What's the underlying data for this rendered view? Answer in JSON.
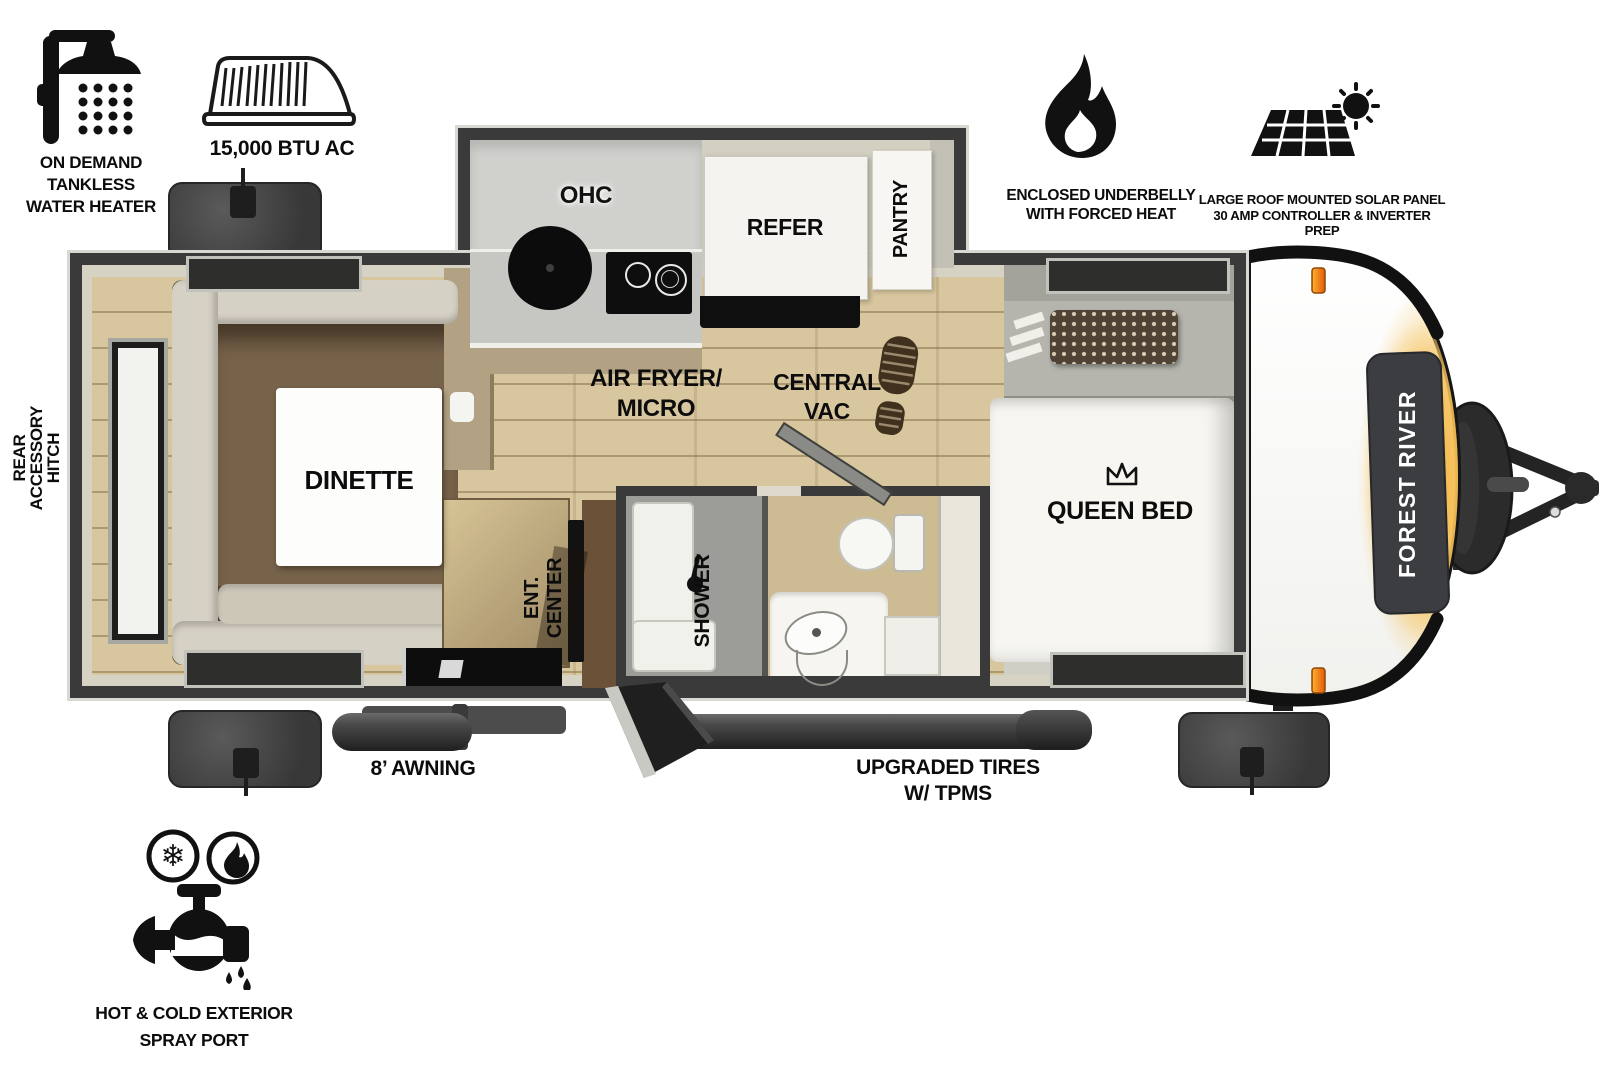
{
  "callouts": {
    "water_heater": "ON DEMAND\nTANKLESS\nWATER HEATER",
    "ac": "15,000 BTU AC",
    "underbelly": "ENCLOSED UNDERBELLY\nWITH FORCED HEAT",
    "solar": "LARGE ROOF MOUNTED SOLAR PANEL\n30 AMP CONTROLLER & INVERTER PREP",
    "rear_hitch": "REAR\nACCESSORY\nHITCH",
    "awning": "8’ AWNING",
    "tires": "UPGRADED TIRES\nW/ TPMS",
    "spray_port": "HOT & COLD EXTERIOR\nSPRAY PORT"
  },
  "rooms": {
    "dinette": "DINETTE",
    "ohc": "OHC",
    "refer": "REFER",
    "pantry": "PANTRY",
    "air_fryer_micro": "AIR FRYER/\nMICRO",
    "central_vac": "CENTRAL\nVAC",
    "ent_center": "ENT.\nCENTER",
    "shower": "SHOWER",
    "queen_bed": "QUEEN BED"
  },
  "brand": {
    "front_cap_logo": "FOREST RIVER"
  },
  "icons": {
    "water_heater": "shower-head-icon",
    "ac": "rooftop-ac-icon",
    "underbelly": "flame-icon",
    "solar": "solar-panel-sun-icon",
    "central_vac": "boot-print-icon",
    "queen_bed": "crown-icon",
    "spray_port": "faucet-hot-cold-icon"
  },
  "colors": {
    "wall_dark": "#3a3a3a",
    "wall_beige": "#d6d2c4",
    "wood_floor": "#d8c69e",
    "bedroom_floor": "#a6a699",
    "counter_gray": "#c6c6c3",
    "cabinet_tan": "#b2a283",
    "sofa_cream": "#d6d1c5",
    "sofa_brown": "#77624a",
    "mattress_white": "#f7f6f1",
    "marker_orange": "#e8731a",
    "glow_yellow": "#f2a93b",
    "panel_dark": "#3b3d40"
  }
}
